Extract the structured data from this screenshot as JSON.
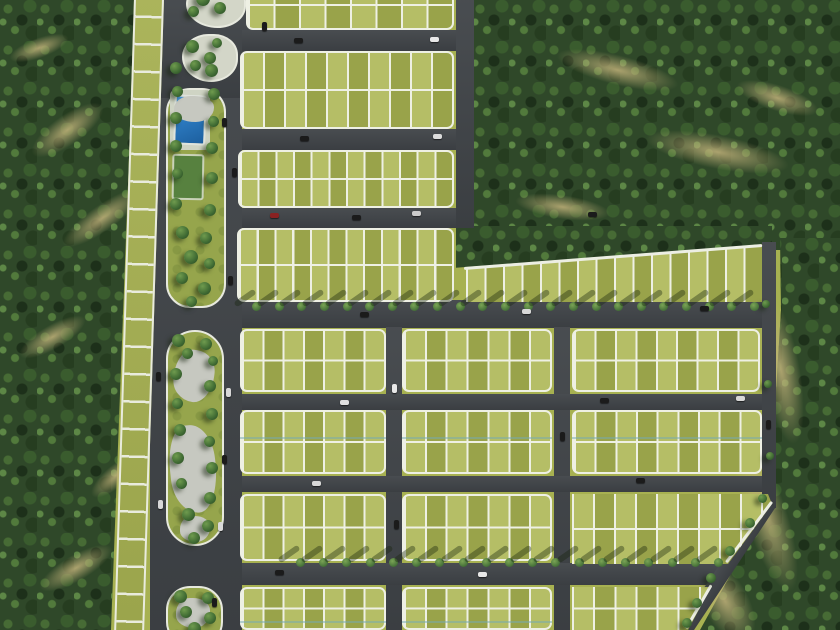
{
  "title": "Aerial master plan render of a residential land subdivision",
  "scene": {
    "width": 840,
    "height": 630,
    "palette": {
      "ground": "#a7b151",
      "road": "#3f4347",
      "line": "#eef0e4",
      "lot": "#a5af53",
      "lot_tint_light": "rgba(238,244,170,0.22)",
      "lot_tint_dark": "rgba(90,100,30,0.16)",
      "forest": "#2f4829",
      "pool_blue": "#2c7ac0",
      "plaza_gray": "#c6c8c0",
      "dirt": "#c1b27a",
      "car_dark": "#1b1b1b",
      "car_light": "#e8e8e8",
      "car_red": "#8a2222"
    },
    "forests": [
      {
        "name": "forest-left",
        "x": 0,
        "y": 0,
        "w": 140,
        "h": 630,
        "clip": "polygon(0 0, 135px 0, 111px 100%, 0 100%)"
      },
      {
        "name": "forest-topright",
        "x": 472,
        "y": 0,
        "w": 368,
        "h": 250,
        "clip": null
      },
      {
        "name": "forest-topright-wedge",
        "x": 456,
        "y": 226,
        "w": 316,
        "h": 48,
        "clip": "polygon(0 0, 100% 0, 100% 37%, 0 87%)"
      },
      {
        "name": "forest-right",
        "x": 560,
        "y": 238,
        "w": 280,
        "h": 392,
        "clip": "polygon(220px 0, 280px 0, 280px 392px, 140px 392px, 209px 267px, 221px 72px)"
      }
    ],
    "patches": [
      {
        "x": 25,
        "y": 115,
        "w": 85,
        "h": 30,
        "r": -35
      },
      {
        "x": 55,
        "y": 205,
        "w": 95,
        "h": 26,
        "r": -35
      },
      {
        "x": 15,
        "y": 325,
        "w": 75,
        "h": 24,
        "r": -30
      },
      {
        "x": 85,
        "y": 465,
        "w": 62,
        "h": 22,
        "r": -40
      },
      {
        "x": 35,
        "y": 555,
        "w": 82,
        "h": 26,
        "r": -30
      },
      {
        "x": 8,
        "y": 38,
        "w": 62,
        "h": 20,
        "r": -20
      },
      {
        "x": 555,
        "y": 55,
        "w": 125,
        "h": 30,
        "r": 14
      },
      {
        "x": 645,
        "y": 135,
        "w": 145,
        "h": 34,
        "r": 11
      },
      {
        "x": 515,
        "y": 195,
        "w": 95,
        "h": 24,
        "r": 8
      },
      {
        "x": 735,
        "y": 85,
        "w": 85,
        "h": 26,
        "r": 18
      },
      {
        "x": 762,
        "y": 295,
        "w": 38,
        "h": 150,
        "r": -10
      },
      {
        "x": 745,
        "y": 435,
        "w": 42,
        "h": 160,
        "r": -18
      },
      {
        "x": 702,
        "y": 555,
        "w": 46,
        "h": 92,
        "r": -30
      }
    ],
    "roads": [
      {
        "name": "road-boulevard",
        "x": 150,
        "y": 0,
        "w": 92,
        "h": 630,
        "r": 0
      },
      {
        "name": "road-entry",
        "x": 150,
        "y": 0,
        "w": 108,
        "h": 98,
        "r": 0
      },
      {
        "name": "road-r1",
        "x": 242,
        "y": 30,
        "w": 222,
        "h": 21,
        "r": 0
      },
      {
        "name": "road-r2",
        "x": 242,
        "y": 129,
        "w": 222,
        "h": 21,
        "r": 0
      },
      {
        "name": "road-r3",
        "x": 242,
        "y": 208,
        "w": 228,
        "h": 20,
        "r": 0
      },
      {
        "name": "road-v2",
        "x": 456,
        "y": 0,
        "w": 18,
        "h": 228,
        "r": 0
      },
      {
        "name": "road-r4",
        "x": 242,
        "y": 300,
        "w": 520,
        "h": 28,
        "r": 0
      },
      {
        "name": "road-v3",
        "x": 386,
        "y": 327,
        "w": 16,
        "h": 303,
        "r": 0
      },
      {
        "name": "road-v4",
        "x": 554,
        "y": 327,
        "w": 16,
        "h": 303,
        "r": 0
      },
      {
        "name": "road-r5",
        "x": 242,
        "y": 394,
        "w": 520,
        "h": 16,
        "r": 0
      },
      {
        "name": "road-r6",
        "x": 242,
        "y": 476,
        "w": 520,
        "h": 16,
        "r": 0
      },
      {
        "name": "road-r7",
        "x": 242,
        "y": 563,
        "w": 480,
        "h": 22,
        "r": 0
      },
      {
        "name": "road-boundary-north",
        "x": 762,
        "y": 242,
        "w": 14,
        "h": 266,
        "r": 0
      },
      {
        "name": "road-boundary-diagonal",
        "x": 686,
        "y": 621,
        "w": 150,
        "h": 15,
        "r": -56.4
      }
    ],
    "ladder": {
      "x": 124,
      "y": -12,
      "w": 30,
      "h": 658,
      "r": 1.8
    },
    "blocks": [
      {
        "name": "block-t1",
        "x": 246,
        "y": -20,
        "w": 208,
        "h": 50,
        "cols": 8,
        "rows": 2,
        "clip": null
      },
      {
        "name": "block-t2",
        "x": 240,
        "y": 51,
        "w": 214,
        "h": 78,
        "cols": 10,
        "rows": 2,
        "clip": null
      },
      {
        "name": "block-t3",
        "x": 238,
        "y": 150,
        "w": 216,
        "h": 58,
        "cols": 12,
        "rows": 2,
        "clip": null
      },
      {
        "name": "block-t4",
        "x": 237,
        "y": 228,
        "w": 217,
        "h": 74,
        "cols": 12,
        "rows": 2,
        "clip": null
      },
      {
        "name": "block-t5-diagonal",
        "x": 466,
        "y": 228,
        "w": 296,
        "h": 74,
        "cols": 16,
        "rows": 1,
        "clip": "polygon(0 55%, 100% 22%, 100% 100%, 0 100%)"
      },
      {
        "name": "block-a1",
        "x": 240,
        "y": 329,
        "w": 146,
        "h": 63,
        "cols": 7,
        "rows": 2,
        "clip": null
      },
      {
        "name": "block-b1",
        "x": 402,
        "y": 329,
        "w": 150,
        "h": 63,
        "cols": 7,
        "rows": 2,
        "clip": null
      },
      {
        "name": "block-c1",
        "x": 572,
        "y": 329,
        "w": 188,
        "h": 63,
        "cols": 9,
        "rows": 2,
        "clip": null
      },
      {
        "name": "block-a2",
        "x": 240,
        "y": 410,
        "w": 146,
        "h": 64,
        "cols": 7,
        "rows": 2,
        "clip": null
      },
      {
        "name": "block-b2",
        "x": 402,
        "y": 410,
        "w": 150,
        "h": 64,
        "cols": 7,
        "rows": 2,
        "clip": null
      },
      {
        "name": "block-c2",
        "x": 572,
        "y": 410,
        "w": 190,
        "h": 64,
        "cols": 9,
        "rows": 2,
        "clip": null
      },
      {
        "name": "block-a3",
        "x": 240,
        "y": 494,
        "w": 146,
        "h": 67,
        "cols": 7,
        "rows": 2,
        "clip": null
      },
      {
        "name": "block-b3",
        "x": 402,
        "y": 494,
        "w": 150,
        "h": 67,
        "cols": 7,
        "rows": 2,
        "clip": null
      },
      {
        "name": "block-c3",
        "x": 572,
        "y": 494,
        "w": 210,
        "h": 70,
        "cols": 10,
        "rows": 2,
        "clip": "polygon(0 0, 196px 0, 200px 10px, 156px 70px, 0 70px)"
      },
      {
        "name": "block-a4",
        "x": 240,
        "y": 587,
        "w": 146,
        "h": 43,
        "cols": 7,
        "rows": 2,
        "clip": null
      },
      {
        "name": "block-b4",
        "x": 402,
        "y": 587,
        "w": 150,
        "h": 43,
        "cols": 7,
        "rows": 2,
        "clip": null
      },
      {
        "name": "block-c4",
        "x": 572,
        "y": 587,
        "w": 148,
        "h": 43,
        "cols": 7,
        "rows": 2,
        "clip": "polygon(0 0, 139px 0, 116px 43px, 0 43px)"
      }
    ],
    "edges": [
      {
        "name": "edge-diagonal-band-top",
        "x": 464,
        "y": 267,
        "len": 299,
        "r": -4.4
      },
      {
        "name": "edge-c3-cut",
        "x": 726,
        "y": 561,
        "len": 76,
        "r": -53
      },
      {
        "name": "edge-c4-cut",
        "x": 686,
        "y": 627,
        "len": 50,
        "r": -60
      }
    ],
    "water_lines": [
      {
        "x": 240,
        "y": 437,
        "w": 146
      },
      {
        "x": 402,
        "y": 437,
        "w": 150
      },
      {
        "x": 572,
        "y": 437,
        "w": 190
      },
      {
        "x": 240,
        "y": 621,
        "w": 146
      },
      {
        "x": 402,
        "y": 621,
        "w": 150
      }
    ],
    "park": {
      "entry_islands": [
        {
          "name": "entry-island-1",
          "x": 186,
          "y": -18,
          "w": 60,
          "h": 46
        },
        {
          "name": "entry-island-2",
          "x": 182,
          "y": 34,
          "w": 56,
          "h": 48
        }
      ],
      "pool_park": {
        "x": 166,
        "y": 88,
        "w": 60,
        "h": 220,
        "radius": 24
      },
      "deck": {
        "x": 170,
        "y": 90,
        "w": 40,
        "h": 60
      },
      "pool": {
        "x": 174,
        "y": 95,
        "w": 32,
        "h": 50,
        "r": 2
      },
      "court": {
        "x": 172,
        "y": 154,
        "w": 32,
        "h": 46,
        "r": 1
      },
      "amenity_islands": [
        {
          "name": "amenity-island-1",
          "x": 166,
          "y": 330,
          "w": 58,
          "h": 216,
          "radius": 29
        },
        {
          "name": "amenity-island-2",
          "x": 166,
          "y": 586,
          "w": 57,
          "h": 60,
          "radius": 24
        }
      ],
      "plazas": [
        {
          "x": 174,
          "y": 350,
          "w": 40,
          "h": 52,
          "r": 8
        },
        {
          "x": 170,
          "y": 425,
          "w": 46,
          "h": 88,
          "r": -6
        },
        {
          "x": 180,
          "y": 516,
          "w": 30,
          "h": 26,
          "r": 0
        },
        {
          "x": 176,
          "y": 598,
          "w": 34,
          "h": 30,
          "r": 0
        },
        {
          "x": 174,
          "y": 96,
          "w": 40,
          "h": 26,
          "r": 0
        }
      ]
    },
    "trees": [
      {
        "x": 196,
        "y": -8,
        "s": 14
      },
      {
        "x": 214,
        "y": 2,
        "s": 12
      },
      {
        "x": 188,
        "y": 6,
        "s": 11
      },
      {
        "x": 186,
        "y": 40,
        "s": 13
      },
      {
        "x": 204,
        "y": 52,
        "s": 12
      },
      {
        "x": 190,
        "y": 60,
        "s": 11
      },
      {
        "x": 212,
        "y": 38,
        "s": 10
      },
      {
        "x": 170,
        "y": 62,
        "s": 12
      },
      {
        "x": 205,
        "y": 64,
        "s": 13
      },
      {
        "x": 172,
        "y": 86,
        "s": 11
      },
      {
        "x": 208,
        "y": 88,
        "s": 12
      },
      {
        "x": 170,
        "y": 112,
        "s": 12
      },
      {
        "x": 208,
        "y": 116,
        "s": 11
      },
      {
        "x": 170,
        "y": 140,
        "s": 12
      },
      {
        "x": 206,
        "y": 142,
        "s": 12
      },
      {
        "x": 172,
        "y": 168,
        "s": 11
      },
      {
        "x": 206,
        "y": 172,
        "s": 12
      },
      {
        "x": 170,
        "y": 198,
        "s": 12
      },
      {
        "x": 204,
        "y": 204,
        "s": 12
      },
      {
        "x": 176,
        "y": 226,
        "s": 13
      },
      {
        "x": 200,
        "y": 232,
        "s": 12
      },
      {
        "x": 184,
        "y": 250,
        "s": 14
      },
      {
        "x": 204,
        "y": 258,
        "s": 11
      },
      {
        "x": 176,
        "y": 272,
        "s": 12
      },
      {
        "x": 198,
        "y": 282,
        "s": 13
      },
      {
        "x": 186,
        "y": 296,
        "s": 11
      },
      {
        "x": 172,
        "y": 334,
        "s": 13
      },
      {
        "x": 200,
        "y": 338,
        "s": 12
      },
      {
        "x": 182,
        "y": 348,
        "s": 11
      },
      {
        "x": 208,
        "y": 356,
        "s": 10
      },
      {
        "x": 170,
        "y": 368,
        "s": 12
      },
      {
        "x": 204,
        "y": 380,
        "s": 12
      },
      {
        "x": 172,
        "y": 398,
        "s": 11
      },
      {
        "x": 206,
        "y": 408,
        "s": 12
      },
      {
        "x": 174,
        "y": 424,
        "s": 12
      },
      {
        "x": 204,
        "y": 436,
        "s": 11
      },
      {
        "x": 172,
        "y": 452,
        "s": 12
      },
      {
        "x": 206,
        "y": 462,
        "s": 12
      },
      {
        "x": 176,
        "y": 478,
        "s": 11
      },
      {
        "x": 204,
        "y": 492,
        "s": 12
      },
      {
        "x": 182,
        "y": 508,
        "s": 13
      },
      {
        "x": 202,
        "y": 520,
        "s": 12
      },
      {
        "x": 188,
        "y": 532,
        "s": 12
      },
      {
        "x": 174,
        "y": 590,
        "s": 13
      },
      {
        "x": 202,
        "y": 592,
        "s": 12
      },
      {
        "x": 180,
        "y": 606,
        "s": 12
      },
      {
        "x": 204,
        "y": 612,
        "s": 12
      },
      {
        "x": 188,
        "y": 622,
        "s": 13
      },
      {
        "x": 745,
        "y": 518,
        "s": 10
      },
      {
        "x": 725,
        "y": 546,
        "s": 10
      },
      {
        "x": 706,
        "y": 573,
        "s": 10
      },
      {
        "x": 692,
        "y": 598,
        "s": 10
      },
      {
        "x": 682,
        "y": 618,
        "s": 10
      },
      {
        "x": 758,
        "y": 494,
        "s": 9
      },
      {
        "x": 762,
        "y": 300,
        "s": 8
      },
      {
        "x": 764,
        "y": 380,
        "s": 8
      },
      {
        "x": 766,
        "y": 452,
        "s": 8
      }
    ],
    "tree_rows": [
      {
        "name": "street-trees-r4",
        "y": 302,
        "x1": 252,
        "x2": 750,
        "n": 23,
        "s": 9
      },
      {
        "name": "street-trees-r7",
        "y": 558,
        "x1": 296,
        "x2": 714,
        "n": 19,
        "s": 9
      }
    ],
    "cars": [
      {
        "x": 294,
        "y": 38,
        "c": "#1b1b1b",
        "v": false
      },
      {
        "x": 430,
        "y": 37,
        "c": "#e8e8e8",
        "v": false
      },
      {
        "x": 262,
        "y": 22,
        "c": "#1b1b1b",
        "v": true
      },
      {
        "x": 222,
        "y": 118,
        "c": "#1b1b1b",
        "v": true
      },
      {
        "x": 300,
        "y": 136,
        "c": "#1b1b1b",
        "v": false
      },
      {
        "x": 433,
        "y": 134,
        "c": "#dcdcdc",
        "v": false
      },
      {
        "x": 270,
        "y": 213,
        "c": "#8a2222",
        "v": false
      },
      {
        "x": 352,
        "y": 215,
        "c": "#1b1b1b",
        "v": false
      },
      {
        "x": 412,
        "y": 211,
        "c": "#cccccc",
        "v": false
      },
      {
        "x": 588,
        "y": 212,
        "c": "#1b1b1b",
        "v": false
      },
      {
        "x": 232,
        "y": 168,
        "c": "#1b1b1b",
        "v": true
      },
      {
        "x": 228,
        "y": 276,
        "c": "#1b1b1b",
        "v": true
      },
      {
        "x": 226,
        "y": 388,
        "c": "#d8d8d8",
        "v": true
      },
      {
        "x": 222,
        "y": 455,
        "c": "#1b1b1b",
        "v": true
      },
      {
        "x": 218,
        "y": 522,
        "c": "#dadada",
        "v": true
      },
      {
        "x": 212,
        "y": 598,
        "c": "#1b1b1b",
        "v": true
      },
      {
        "x": 156,
        "y": 372,
        "c": "#1b1b1b",
        "v": true
      },
      {
        "x": 158,
        "y": 500,
        "c": "#d8d8d8",
        "v": true
      },
      {
        "x": 360,
        "y": 312,
        "c": "#1b1b1b",
        "v": false
      },
      {
        "x": 522,
        "y": 309,
        "c": "#d8d8d8",
        "v": false
      },
      {
        "x": 700,
        "y": 306,
        "c": "#1b1b1b",
        "v": false
      },
      {
        "x": 392,
        "y": 384,
        "c": "#e8e8e8",
        "v": true
      },
      {
        "x": 394,
        "y": 520,
        "c": "#1b1b1b",
        "v": true
      },
      {
        "x": 340,
        "y": 400,
        "c": "#e0e0e0",
        "v": false
      },
      {
        "x": 600,
        "y": 398,
        "c": "#1b1b1b",
        "v": false
      },
      {
        "x": 736,
        "y": 396,
        "c": "#d8d8d8",
        "v": false
      },
      {
        "x": 560,
        "y": 432,
        "c": "#1b1b1b",
        "v": true
      },
      {
        "x": 312,
        "y": 481,
        "c": "#d8d8d8",
        "v": false
      },
      {
        "x": 636,
        "y": 478,
        "c": "#1b1b1b",
        "v": false
      },
      {
        "x": 275,
        "y": 570,
        "c": "#1b1b1b",
        "v": false
      },
      {
        "x": 478,
        "y": 572,
        "c": "#e8e8e8",
        "v": false
      },
      {
        "x": 766,
        "y": 420,
        "c": "#1b1b1b",
        "v": true
      }
    ]
  }
}
